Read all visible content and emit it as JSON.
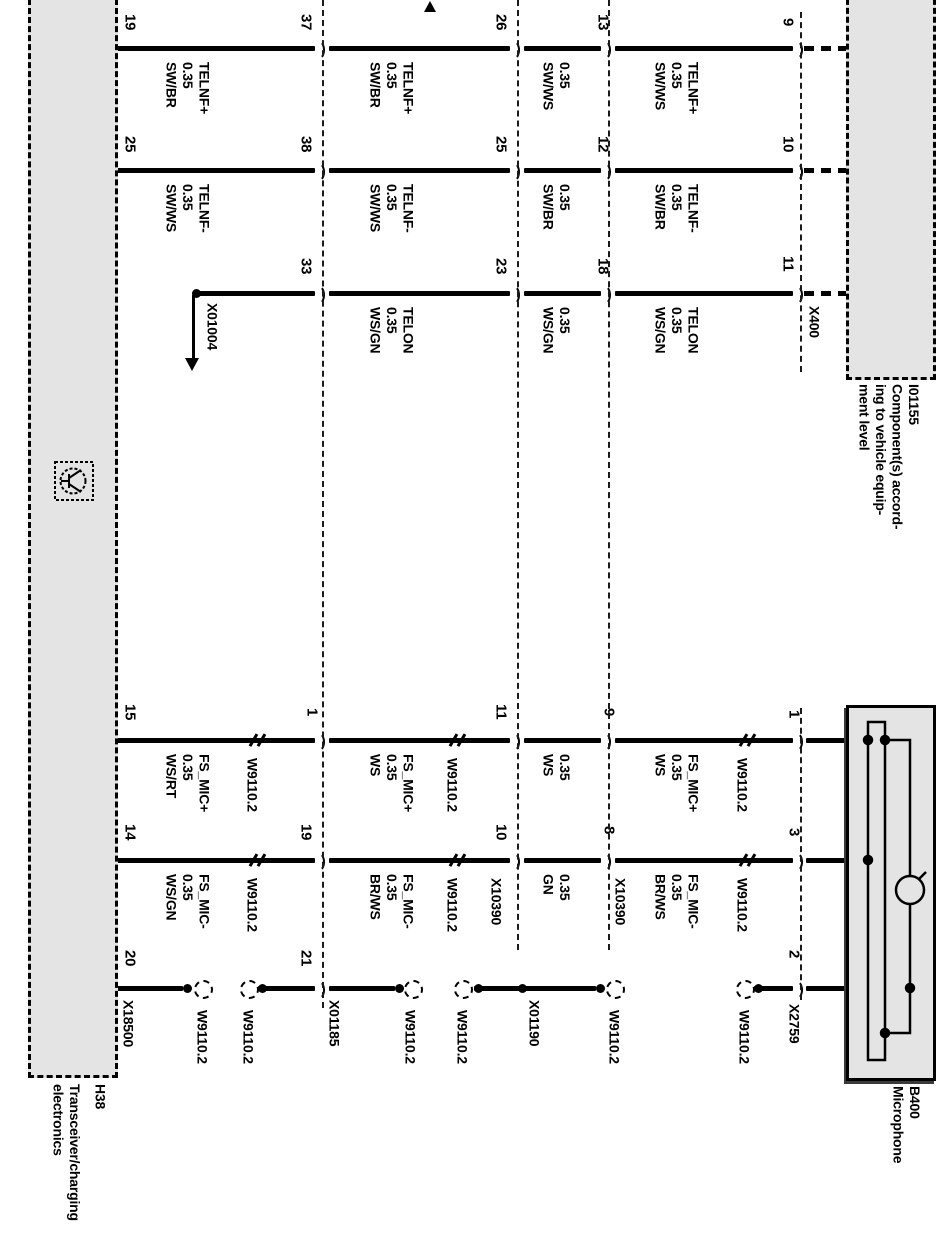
{
  "diagram": {
    "components": {
      "h38": {
        "code": "H38",
        "name": "Transceiver/charging\nelectronics"
      },
      "i01155": {
        "code": "I01155",
        "name": "Component(s) accord-\ning to vehicle equip-\nment level"
      },
      "b400": {
        "code": "B400",
        "name": "Microphone"
      }
    },
    "colors": {
      "box_fill": "#e4e4e4",
      "line": "#000000",
      "background": "#ffffff"
    },
    "boxes": [
      {
        "name": "component-box-h38",
        "style": "dashed",
        "x": 28,
        "y": -10,
        "w": 84,
        "h": 1082
      },
      {
        "name": "component-box-i01155",
        "style": "dashed",
        "x": 846,
        "y": -10,
        "w": 84,
        "h": 384
      },
      {
        "name": "component-box-b400",
        "style": "solid",
        "x": 846,
        "y": 705,
        "w": 84,
        "h": 370
      }
    ],
    "connector_lines": [
      {
        "x": 322,
        "y1": 0,
        "y2": 1008
      },
      {
        "x": 517,
        "y1": 0,
        "y2": 950
      },
      {
        "x": 608,
        "y1": 0,
        "y2": 950
      },
      {
        "x": 800,
        "y1": 12,
        "y2": 372
      },
      {
        "x": 800,
        "y1": 708,
        "y2": 1000
      }
    ],
    "wires": [
      {
        "y": 48,
        "segs": [
          [
            113,
            315
          ],
          [
            329,
            510
          ],
          [
            524,
            601
          ],
          [
            615,
            793
          ]
        ]
      },
      {
        "y": 170,
        "segs": [
          [
            113,
            315
          ],
          [
            329,
            510
          ],
          [
            524,
            601
          ],
          [
            615,
            793
          ]
        ]
      },
      {
        "y": 293,
        "segs": [
          [
            196,
            315
          ],
          [
            329,
            510
          ],
          [
            524,
            601
          ],
          [
            615,
            793
          ]
        ]
      },
      {
        "y": 740,
        "segs": [
          [
            113,
            315
          ],
          [
            329,
            510
          ],
          [
            524,
            601
          ],
          [
            615,
            793
          ],
          [
            806,
            910
          ]
        ]
      },
      {
        "y": 860,
        "segs": [
          [
            113,
            315
          ],
          [
            329,
            510
          ],
          [
            524,
            601
          ],
          [
            615,
            793
          ],
          [
            806,
            868
          ]
        ]
      },
      {
        "y": 988,
        "segs": [
          [
            113,
            183
          ],
          [
            258,
            315
          ],
          [
            329,
            395
          ],
          [
            474,
            596
          ],
          [
            754,
            793
          ],
          [
            806,
            910
          ]
        ]
      }
    ],
    "dashed_stubs": [
      {
        "y": 48,
        "x1": 804,
        "x2": 846
      },
      {
        "y": 170,
        "x1": 804,
        "x2": 846
      },
      {
        "y": 293,
        "x1": 804,
        "x2": 846
      }
    ],
    "junction_arcs_right": [
      {
        "x": 322,
        "y": 48
      },
      {
        "x": 517,
        "y": 48
      },
      {
        "x": 608,
        "y": 48
      },
      {
        "x": 800,
        "y": 48
      },
      {
        "x": 322,
        "y": 170
      },
      {
        "x": 517,
        "y": 170
      },
      {
        "x": 608,
        "y": 170
      },
      {
        "x": 800,
        "y": 170
      },
      {
        "x": 322,
        "y": 293
      },
      {
        "x": 517,
        "y": 293
      },
      {
        "x": 608,
        "y": 293
      },
      {
        "x": 800,
        "y": 293
      },
      {
        "x": 322,
        "y": 740
      },
      {
        "x": 517,
        "y": 740
      },
      {
        "x": 608,
        "y": 740
      },
      {
        "x": 800,
        "y": 740
      },
      {
        "x": 322,
        "y": 860
      },
      {
        "x": 517,
        "y": 860
      },
      {
        "x": 608,
        "y": 860
      },
      {
        "x": 800,
        "y": 860
      },
      {
        "x": 322,
        "y": 988
      },
      {
        "x": 800,
        "y": 988
      }
    ],
    "exit_arcs_left": [
      {
        "x": 105,
        "y": 48
      },
      {
        "x": 105,
        "y": 170
      },
      {
        "x": 105,
        "y": 740
      },
      {
        "x": 105,
        "y": 860
      },
      {
        "x": 105,
        "y": 988
      }
    ],
    "pins": [
      {
        "t": "19",
        "x": 121,
        "y": 14
      },
      {
        "t": "25",
        "x": 121,
        "y": 136
      },
      {
        "t": "37",
        "x": 297,
        "y": 14
      },
      {
        "t": "38",
        "x": 297,
        "y": 136
      },
      {
        "t": "33",
        "x": 297,
        "y": 258
      },
      {
        "t": "26",
        "x": 492,
        "y": 14
      },
      {
        "t": "25",
        "x": 492,
        "y": 136
      },
      {
        "t": "23",
        "x": 492,
        "y": 258
      },
      {
        "t": "13",
        "x": 594,
        "y": 14
      },
      {
        "t": "12",
        "x": 594,
        "y": 136
      },
      {
        "t": "18",
        "x": 594,
        "y": 258
      },
      {
        "t": "9",
        "x": 779,
        "y": 18
      },
      {
        "t": "10",
        "x": 779,
        "y": 136
      },
      {
        "t": "11",
        "x": 779,
        "y": 256
      },
      {
        "t": "15",
        "x": 121,
        "y": 704
      },
      {
        "t": "14",
        "x": 121,
        "y": 824
      },
      {
        "t": "20",
        "x": 121,
        "y": 950
      },
      {
        "t": "1",
        "x": 303,
        "y": 708
      },
      {
        "t": "19",
        "x": 297,
        "y": 824
      },
      {
        "t": "21",
        "x": 297,
        "y": 950
      },
      {
        "t": "11",
        "x": 492,
        "y": 704
      },
      {
        "t": "10",
        "x": 492,
        "y": 824
      },
      {
        "t": "9",
        "x": 600,
        "y": 708
      },
      {
        "t": "8",
        "x": 600,
        "y": 826
      },
      {
        "t": "1",
        "x": 785,
        "y": 710
      },
      {
        "t": "3",
        "x": 785,
        "y": 828
      },
      {
        "t": "2",
        "x": 785,
        "y": 950
      }
    ],
    "wire_labels": [
      {
        "t": "TELNF+\n0.35\nSW/BR",
        "x": 163,
        "y": 62
      },
      {
        "t": "TELNF+\n0.35\nSW/BR",
        "x": 367,
        "y": 62
      },
      {
        "t": "0.35\nSW/WS",
        "x": 540,
        "y": 62
      },
      {
        "t": "TELNF+\n0.35\nSW/WS",
        "x": 652,
        "y": 62
      },
      {
        "t": "TELNF-\n0.35\nSW/WS",
        "x": 163,
        "y": 184
      },
      {
        "t": "TELNF-\n0.35\nSW/WS",
        "x": 367,
        "y": 184
      },
      {
        "t": "0.35\nSW/BR",
        "x": 540,
        "y": 184
      },
      {
        "t": "TELNF-\n0.35\nSW/BR",
        "x": 652,
        "y": 184
      },
      {
        "t": "TELON\n0.35\nWS/GN",
        "x": 367,
        "y": 307
      },
      {
        "t": "0.35\nWS/GN",
        "x": 540,
        "y": 307
      },
      {
        "t": "TELON\n0.35\nWS/GN",
        "x": 652,
        "y": 307
      },
      {
        "t": "FS_MIC+\n0.35\nWS/RT",
        "x": 163,
        "y": 754
      },
      {
        "t": "FS_MIC+\n0.35\nWS",
        "x": 367,
        "y": 754
      },
      {
        "t": "0.35\nWS",
        "x": 540,
        "y": 754
      },
      {
        "t": "FS_MIC+\n0.35\nWS",
        "x": 652,
        "y": 754
      },
      {
        "t": "FS_MIC-\n0.35\nWS/GN",
        "x": 163,
        "y": 874
      },
      {
        "t": "FS_MIC-\n0.35\nBR/WS",
        "x": 367,
        "y": 874
      },
      {
        "t": "0.35\nGN",
        "x": 540,
        "y": 874
      },
      {
        "t": "FS_MIC-\n0.35\nBR/WS",
        "x": 652,
        "y": 874
      }
    ],
    "connector_labels": [
      {
        "t": "X400",
        "x": 806,
        "y": 306
      },
      {
        "t": "X18500",
        "x": 120,
        "y": 1000
      },
      {
        "t": "X01185",
        "x": 326,
        "y": 1000
      },
      {
        "t": "X10390",
        "x": 488,
        "y": 878
      },
      {
        "t": "X10390",
        "x": 612,
        "y": 878
      },
      {
        "t": "X01190",
        "x": 526,
        "y": 1000
      },
      {
        "t": "X2759",
        "x": 786,
        "y": 1004
      },
      {
        "t": "X01004",
        "x": 204,
        "y": 303
      }
    ],
    "twisted_pair_labels": [
      {
        "t": "W9110.2",
        "x": 244,
        "y": 758
      },
      {
        "t": "W9110.2",
        "x": 444,
        "y": 758
      },
      {
        "t": "W9110.2",
        "x": 734,
        "y": 758
      },
      {
        "t": "W9110.2",
        "x": 244,
        "y": 878
      },
      {
        "t": "W9110.2",
        "x": 444,
        "y": 878
      },
      {
        "t": "W9110.2",
        "x": 734,
        "y": 878
      },
      {
        "t": "W9110.2",
        "x": 194,
        "y": 1010
      },
      {
        "t": "W9110.2",
        "x": 240,
        "y": 1010
      },
      {
        "t": "W9110.2",
        "x": 402,
        "y": 1010
      },
      {
        "t": "W9110.2",
        "x": 454,
        "y": 1010
      },
      {
        "t": "W9110.2",
        "x": 606,
        "y": 1010
      },
      {
        "t": "W9110.2",
        "x": 736,
        "y": 1010
      }
    ],
    "twist_marks": [
      {
        "x": 252,
        "y": 740
      },
      {
        "x": 452,
        "y": 740
      },
      {
        "x": 742,
        "y": 740
      },
      {
        "x": 252,
        "y": 860
      },
      {
        "x": 452,
        "y": 860
      },
      {
        "x": 742,
        "y": 860
      }
    ],
    "shield_rings": [
      {
        "x": 202,
        "y": 988
      },
      {
        "x": 248,
        "y": 988
      },
      {
        "x": 412,
        "y": 988
      },
      {
        "x": 462,
        "y": 988
      },
      {
        "x": 614,
        "y": 988
      },
      {
        "x": 744,
        "y": 988
      }
    ],
    "junction_dots": [
      {
        "x": 187,
        "y": 988
      },
      {
        "x": 262,
        "y": 988
      },
      {
        "x": 399,
        "y": 988
      },
      {
        "x": 478,
        "y": 988
      },
      {
        "x": 522,
        "y": 988
      },
      {
        "x": 600,
        "y": 988
      },
      {
        "x": 758,
        "y": 988
      },
      {
        "x": 196,
        "y": 293
      }
    ],
    "x01004_arrow": {
      "shaft_x": 193,
      "y1": 295,
      "y2": 360,
      "head_y": 358
    },
    "top_arrow": {
      "x": 424,
      "y": 1
    }
  }
}
